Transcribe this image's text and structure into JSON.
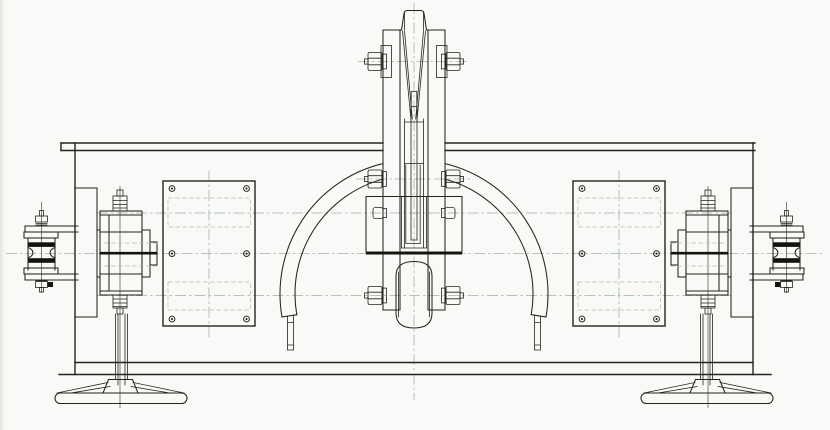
{
  "meta": {
    "title": "Engineering line drawing - overhead suspension clamp assembly, front elevation",
    "drawing_type": "CAD technical drawing (scanned)",
    "visible_text": "none"
  },
  "canvas": {
    "width": 830,
    "height": 430
  },
  "colors": {
    "paper": "#f9f9f7",
    "line": "#23251f",
    "thick": "#13140c",
    "center": "#9cb3a8",
    "hidden": "#b7bbb2"
  },
  "components": [
    {
      "name": "main-beam",
      "desc": "long horizontal channel beam with double-line top and bottom flanges",
      "span_px": [
        61,
        771
      ]
    },
    {
      "name": "center-wedge-clamp",
      "desc": "vertical clevis with tapered wedge between cheek straps, three horizontal bolt pairs, side bearing blocks and lower barrel roller",
      "bolt_pairs": 3
    },
    {
      "name": "wire-guard-arc",
      "desc": "semicircular guard band over the centre with two hanging end strips",
      "outer_radius_px": 134,
      "inner_radius_px": 119
    },
    {
      "name": "cover-plate-left",
      "desc": "rectangular access plate with six screw holes and hidden slot outlines",
      "holes": 6
    },
    {
      "name": "cover-plate-right",
      "desc": "mirror of left cover plate",
      "holes": 6
    },
    {
      "name": "end-assembly-left",
      "desc": "bearing hub with flange bolts, outboard double-groove sheave on bracket arms, pedestal column and oval base foot"
    },
    {
      "name": "end-assembly-right",
      "desc": "mirror image of left end assembly"
    }
  ]
}
